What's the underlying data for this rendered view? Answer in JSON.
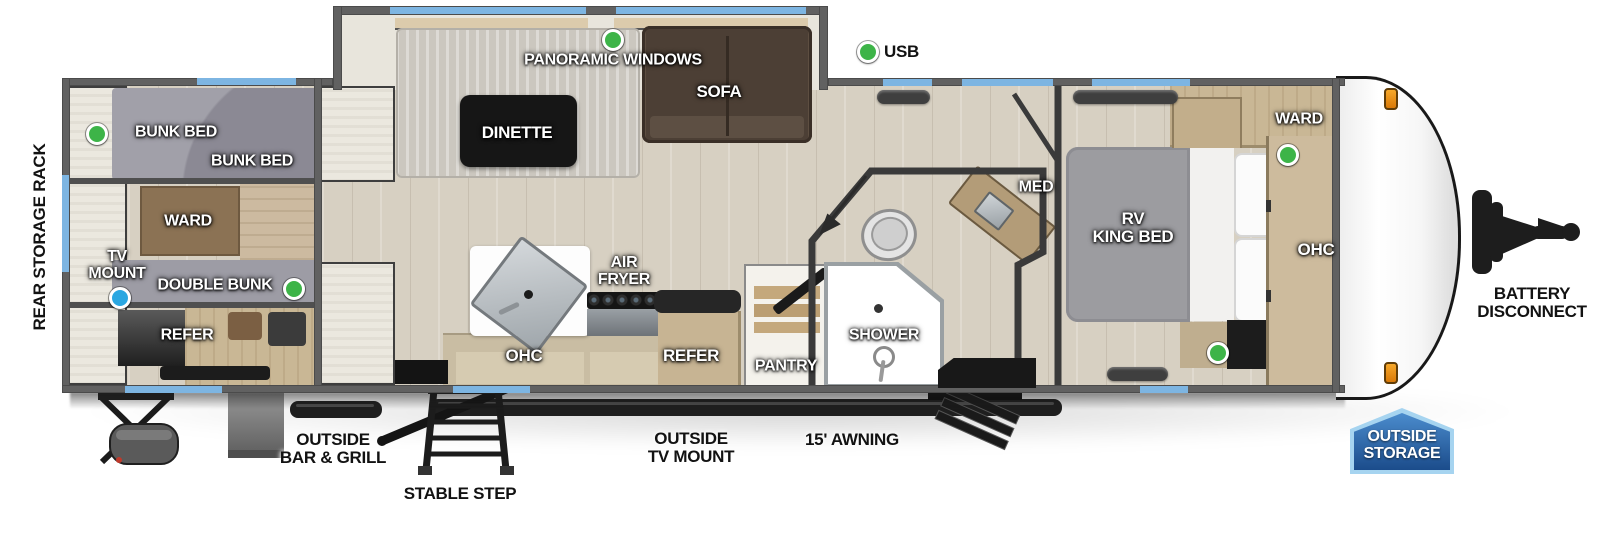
{
  "colors": {
    "window_accent": "#7db5e2",
    "marker_green": "#3db448",
    "marker_blue": "#2aa7e1",
    "badge_blue": "#2a5d9f",
    "wall_gray": "#616161"
  },
  "legend": {
    "usb": "USB"
  },
  "exterior": {
    "rear_storage_rack": "REAR STORAGE RACK",
    "outside_bar_grill": "OUTSIDE\nBAR & GRILL",
    "stable_step": "STABLE STEP",
    "outside_tv_mount": "OUTSIDE\nTV MOUNT",
    "awning": "15' AWNING",
    "battery_disconnect": "BATTERY\nDISCONNECT",
    "outside_storage": "OUTSIDE\nSTORAGE"
  },
  "rear_bunk_room": {
    "bunk_bed_upper": "BUNK BED",
    "bunk_bed_lower": "BUNK BED",
    "ward": "WARD",
    "tv_mount": "TV\nMOUNT",
    "double_bunk": "DOUBLE BUNK",
    "refer": "REFER"
  },
  "living_area": {
    "panoramic_windows": "PANORAMIC WINDOWS",
    "dinette": "DINETTE",
    "sofa": "SOFA",
    "air_fryer": "AIR\nFRYER",
    "ohc": "OHC",
    "refer": "REFER",
    "pantry": "PANTRY"
  },
  "bathroom": {
    "shower": "SHOWER",
    "med": "MED"
  },
  "bedroom": {
    "rv_king_bed": "RV\nKING BED",
    "ward": "WARD",
    "ohc": "OHC"
  }
}
